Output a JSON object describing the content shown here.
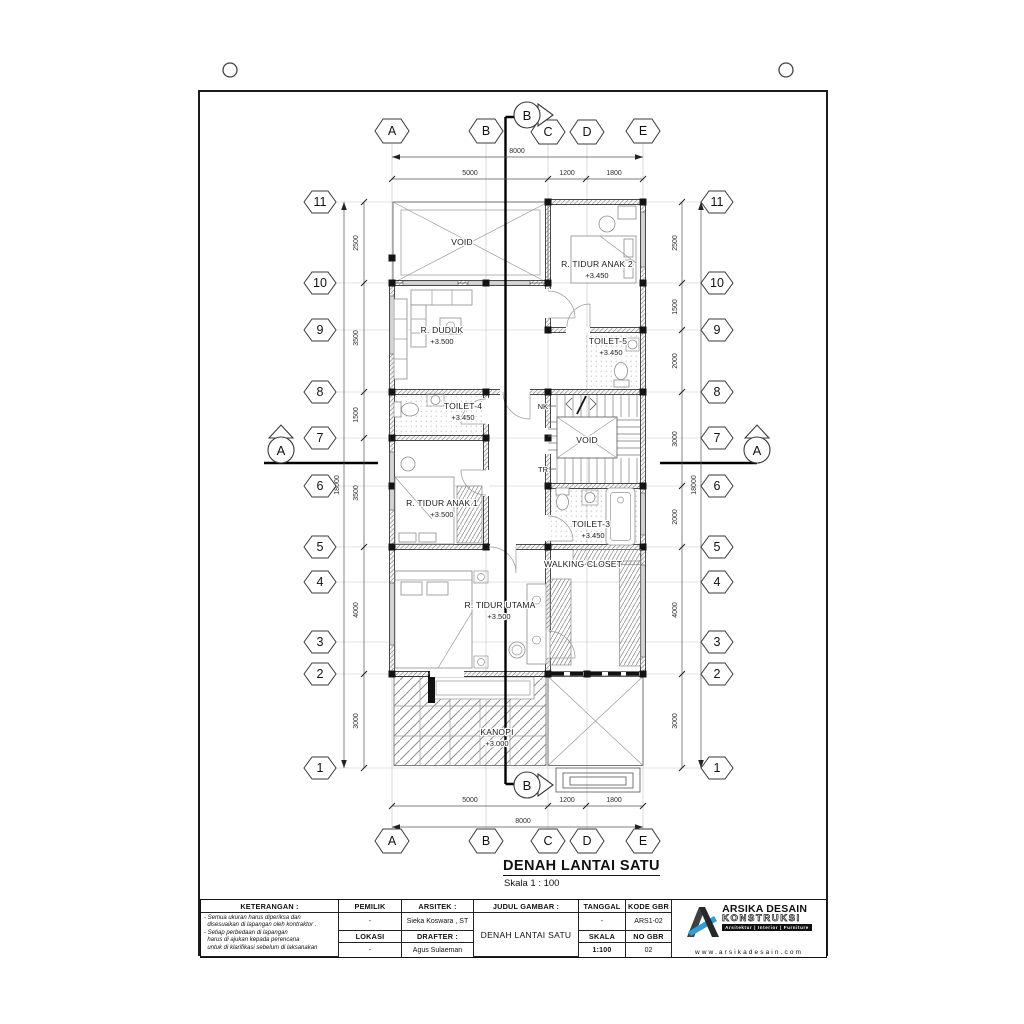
{
  "sheet": {
    "title": "DENAH LANTAI SATU",
    "scale": "Skala 1 : 100"
  },
  "grid": {
    "cols": [
      "A",
      "B",
      "C",
      "D",
      "E"
    ],
    "rows": [
      "11",
      "10",
      "9",
      "8",
      "7",
      "6",
      "5",
      "4",
      "3",
      "2",
      "1"
    ]
  },
  "dims": {
    "top": [
      "5000",
      "1200",
      "1800"
    ],
    "top_total": "8000",
    "bottom": [
      "5000",
      "1200",
      "1800"
    ],
    "bottom_total": "8000",
    "left": [
      "2500",
      "3500",
      "1500",
      "3500",
      "4000",
      "3000"
    ],
    "left_total": "18000",
    "right": [
      "2500",
      "1500",
      "2000",
      "3000",
      "2000",
      "4000",
      "3000"
    ],
    "right_total": "18000"
  },
  "markers": {
    "section_a": "A",
    "section_b": "B"
  },
  "annotations": {
    "nk": "NK",
    "tr": "TR"
  },
  "rooms": {
    "void_top": {
      "name": "VOID"
    },
    "anak2": {
      "name": "R. TIDUR ANAK 2",
      "elev": "+3.450"
    },
    "duduk": {
      "name": "R. DUDUK",
      "elev": "+3.500"
    },
    "toilet5": {
      "name": "TOILET-5",
      "elev": "+3.450"
    },
    "toilet4": {
      "name": "TOILET-4",
      "elev": "+3.450"
    },
    "void_stair": {
      "name": "VOID"
    },
    "anak1": {
      "name": "R. TIDUR ANAK 1",
      "elev": "+3.500"
    },
    "toilet3": {
      "name": "TOILET-3",
      "elev": "+3.450"
    },
    "closet": {
      "name": "WALKING CLOSET"
    },
    "utama": {
      "name": "R. TIDUR UTAMA",
      "elev": "+3.500"
    },
    "kanopi": {
      "name": "KANOPI",
      "elev": "+3.000"
    }
  },
  "titleblock": {
    "keterangan": {
      "header": "KETERANGAN :",
      "lines": [
        "- Semua ukuran harus diperiksa dan",
        "  disesuaikan di lapangan oleh kontraktor .",
        "- Setiap perbedaan di lapangan",
        "  harus di ajukan kepada perencana",
        "  untuk di klarifikasi sebelum di laksanakan"
      ]
    },
    "pemilik": {
      "header": "PEMILIK",
      "value": "-"
    },
    "lokasi": {
      "header": "LOKASI",
      "value": "-"
    },
    "arsitek": {
      "header": "ARSITEK :",
      "value": "Sieka Koswara , ST"
    },
    "drafter": {
      "header": "DRAFTER :",
      "value": "Agus Sulaeman"
    },
    "judul": {
      "header": "JUDUL GAMBAR :",
      "value": "DENAH LANTAI SATU"
    },
    "tanggal": {
      "header": "TANGGAL",
      "value": "-"
    },
    "skala": {
      "header": "SKALA",
      "value": "1:100"
    },
    "kode": {
      "header": "KODE GBR",
      "value": "ARS1-02"
    },
    "nogbr": {
      "header": "NO GBR",
      "value": "02"
    },
    "logo": {
      "name_line1": "ARSIKA DESAIN",
      "name_line2": "KONSTRUKSI",
      "tagline": "Arsitektur | Interior | Furniture",
      "website": "www.arsikadesain.com",
      "accent_color": "#2e9ed5"
    }
  }
}
